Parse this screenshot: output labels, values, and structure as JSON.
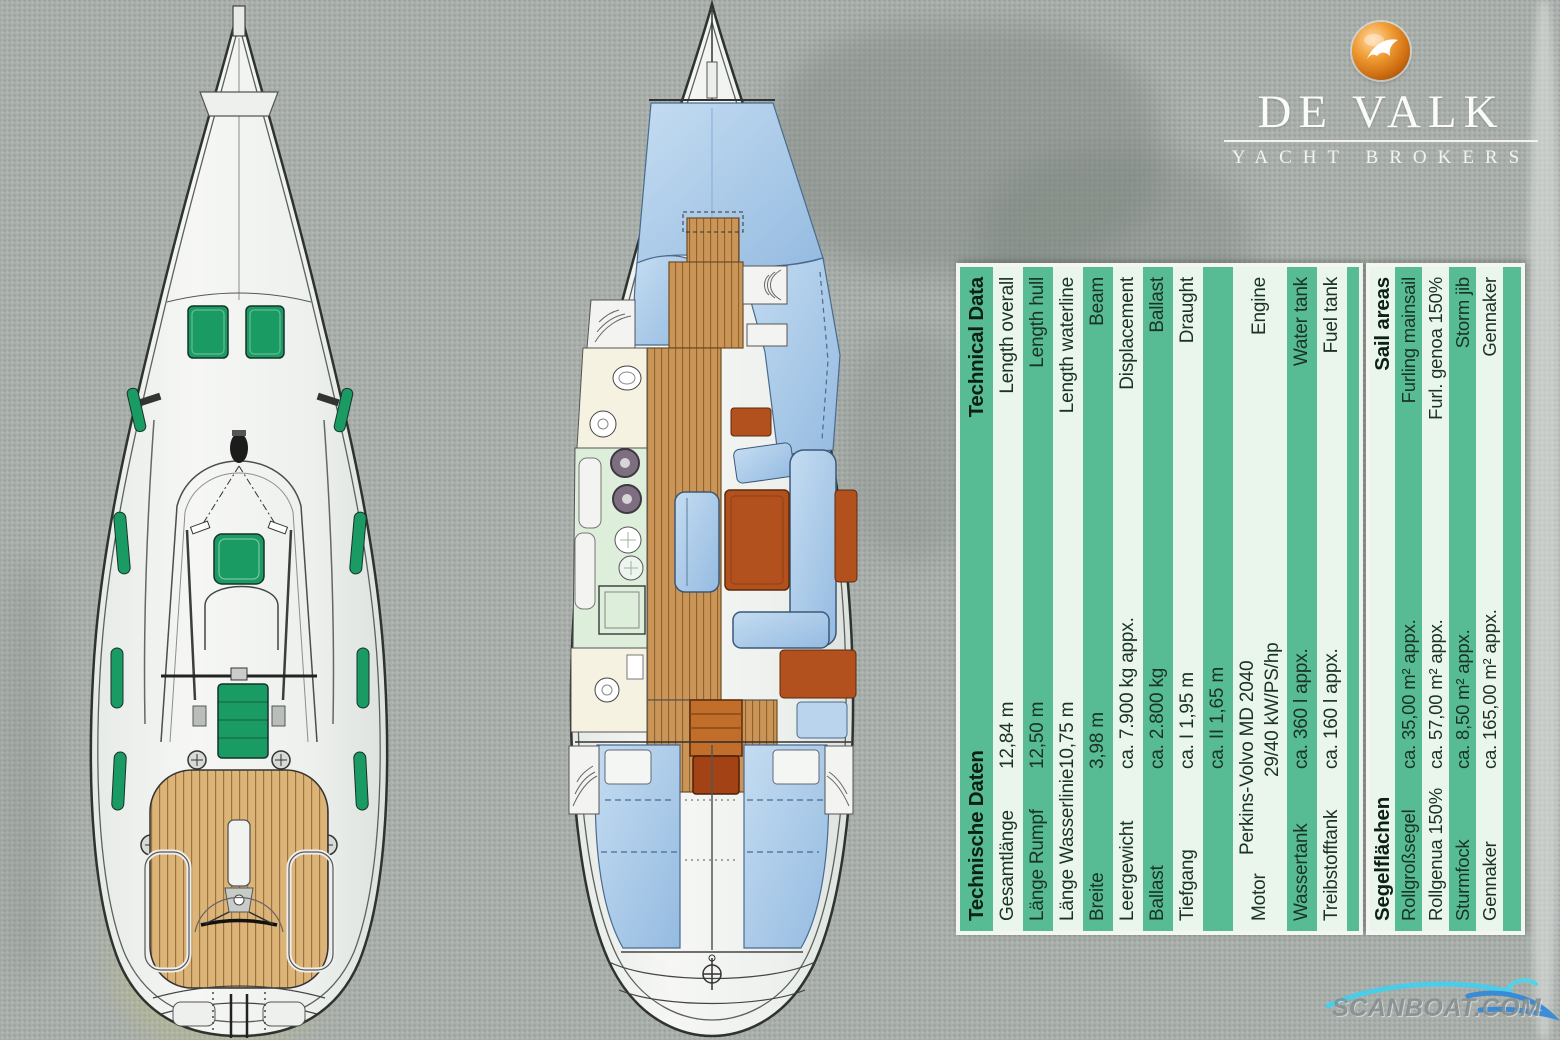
{
  "logo": {
    "brand": "DE VALK",
    "tagline": "YACHT BROKERS",
    "ball_color": "#d97a1d"
  },
  "watermark": {
    "text": "SCANBOAT.COM",
    "wave_colors": [
      "#3fd0ee",
      "#2f86d8"
    ]
  },
  "drawings": {
    "left": "sailing-yacht-deck-plan",
    "middle": "sailing-yacht-interior-layout"
  },
  "spec_table": {
    "colors": {
      "green": "#57bb94",
      "pale": "#eaf6ec",
      "text": "#1b3324"
    },
    "sections": [
      {
        "header": {
          "de": "Technische Daten",
          "en": "Technical Data"
        },
        "header_shade": "green",
        "rows": [
          {
            "de": "Gesamtlänge",
            "value": "12,84 m",
            "en": "Length overall"
          },
          {
            "de": "Länge Rumpf",
            "value": "12,50 m",
            "en": "Length hull"
          },
          {
            "de": "Länge Wasserlinie",
            "value": "10,75 m",
            "en": "Length waterline"
          },
          {
            "de": "Breite",
            "value": "3,98 m",
            "en": "Beam"
          },
          {
            "de": "Leergewicht",
            "value": "ca.  7.900 kg appx.",
            "en": "Displacement"
          },
          {
            "de": "Ballast",
            "value": "ca.  2.800 kg",
            "en": "Ballast"
          },
          {
            "de": "Tiefgang",
            "value": "ca.  I 1,95 m",
            "en": "Draught"
          },
          {
            "de": "",
            "value": "ca.  II 1,65 m",
            "en": ""
          },
          {
            "de": "Motor",
            "value": "Perkins-Volvo MD 2040",
            "value2": "29/40 kW/PS/hp",
            "en": "Engine"
          },
          {
            "de": "Wassertank",
            "value": "ca. 360 l appx.",
            "en": "Water tank"
          },
          {
            "de": "Treibstofftank",
            "value": "ca. 160 l appx.",
            "en": "Fuel tank"
          }
        ]
      },
      {
        "header": {
          "de": "Segelflächen",
          "en": "Sail areas"
        },
        "header_shade": "pale",
        "rows": [
          {
            "de": "Rollgroßsegel",
            "value": "ca.   35,00 m² appx.",
            "en": "Furling mainsail"
          },
          {
            "de": "Rollgenua 150%",
            "value": "ca.   57,00 m² appx.",
            "en": "Furl. genoa 150%"
          },
          {
            "de": "Sturmfock",
            "value": "ca.    8,50 m² appx.",
            "en": "Storm jib"
          },
          {
            "de": "Gennaker",
            "value": "ca. 165,00 m² appx.",
            "en": "Gennaker"
          }
        ]
      }
    ]
  }
}
